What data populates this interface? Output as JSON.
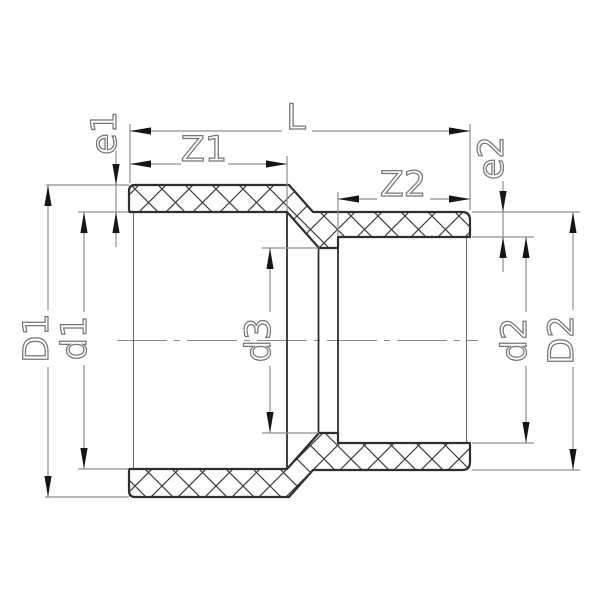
{
  "diagram": {
    "type": "technical-drawing-cross-section",
    "dimension_labels": {
      "overall_length": "L",
      "left_socket_depth": "Z1",
      "right_socket_depth": "Z2",
      "left_wall_thickness": "e1",
      "right_wall_thickness": "e2",
      "left_outer_diameter": "D1",
      "left_socket_bore_diameter": "d1",
      "middle_bore_diameter": "d3",
      "right_socket_bore_diameter": "d2",
      "right_outer_diameter": "D2"
    },
    "colors": {
      "outline": "#2f2f2f",
      "hatch": "#3c3c3c",
      "dimension": "#8f8f8f",
      "arrow": "#161616",
      "label": "#757575",
      "centerline": "#8a8a8a",
      "background": "#ffffff"
    }
  }
}
